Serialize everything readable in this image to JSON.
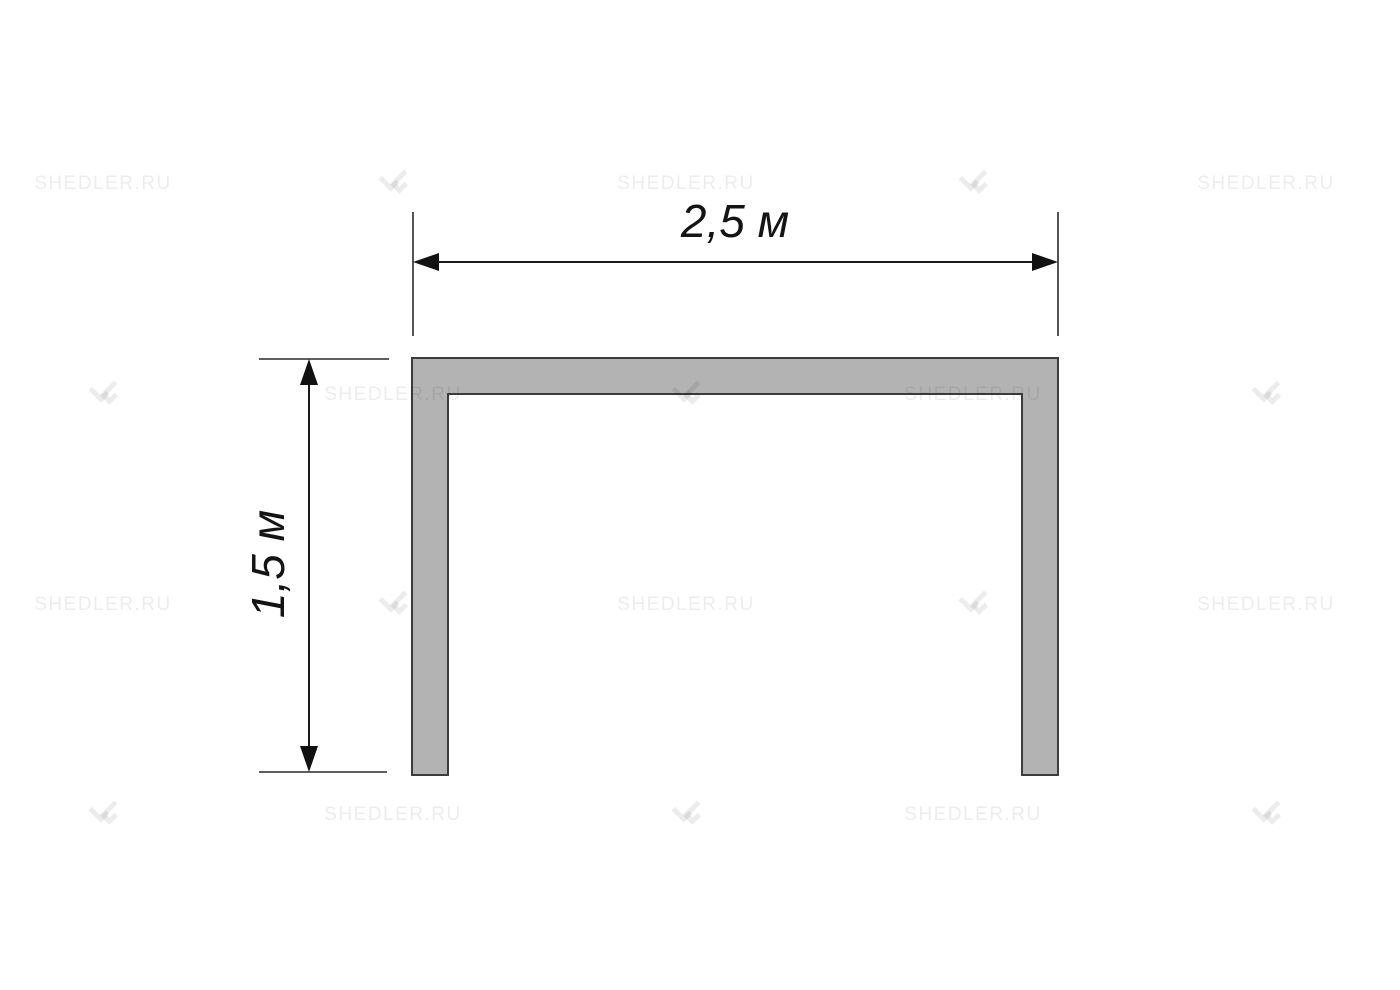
{
  "diagram": {
    "type": "technical-dimension-drawing",
    "shape": "u-profile-frame",
    "width_label": "2,5 м",
    "height_label": "1,5 м",
    "shape_fill": "#b3b3b3",
    "shape_stroke": "#3c3c3c",
    "dimension_line_color": "#1a1a1a"
  },
  "watermark": {
    "text": "SHEDLER.RU",
    "logo_icon": "shedler-logo-icon",
    "color": "rgba(0,0,0,0.075)",
    "columns_x": [
      103,
      393,
      686,
      973,
      1266
    ],
    "rows_y": [
      184,
      395,
      605,
      815
    ]
  }
}
